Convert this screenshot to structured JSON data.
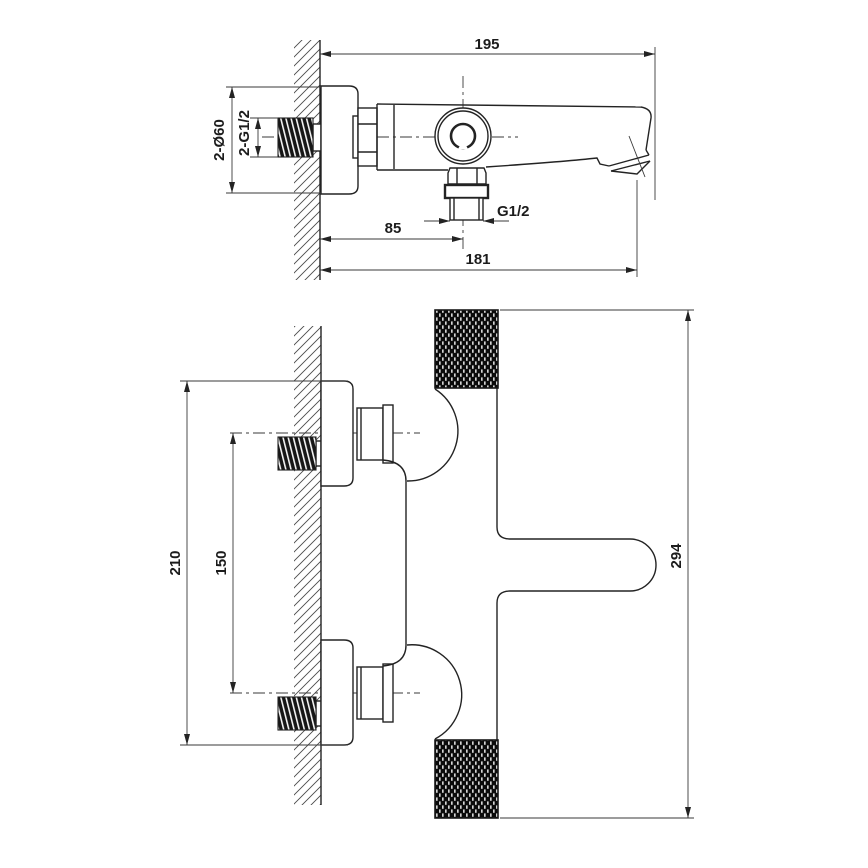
{
  "drawing": {
    "type": "technical-dimension-drawing",
    "subject": "wall-mounted bath mixer faucet, two orthographic views",
    "background_color": "#ffffff",
    "line_color": "#232323",
    "side_view": {
      "dims": {
        "total_depth": "195",
        "spout_reach": "181",
        "outlet_offset": "85",
        "outlet_thread": "G1/2",
        "inlet_thread": "2-G1/2",
        "escutcheon_diameter": "2-Ø60"
      }
    },
    "plan_view": {
      "dims": {
        "escutcheon_span": "210",
        "inlet_spacing": "150",
        "body_length": "294"
      }
    }
  }
}
